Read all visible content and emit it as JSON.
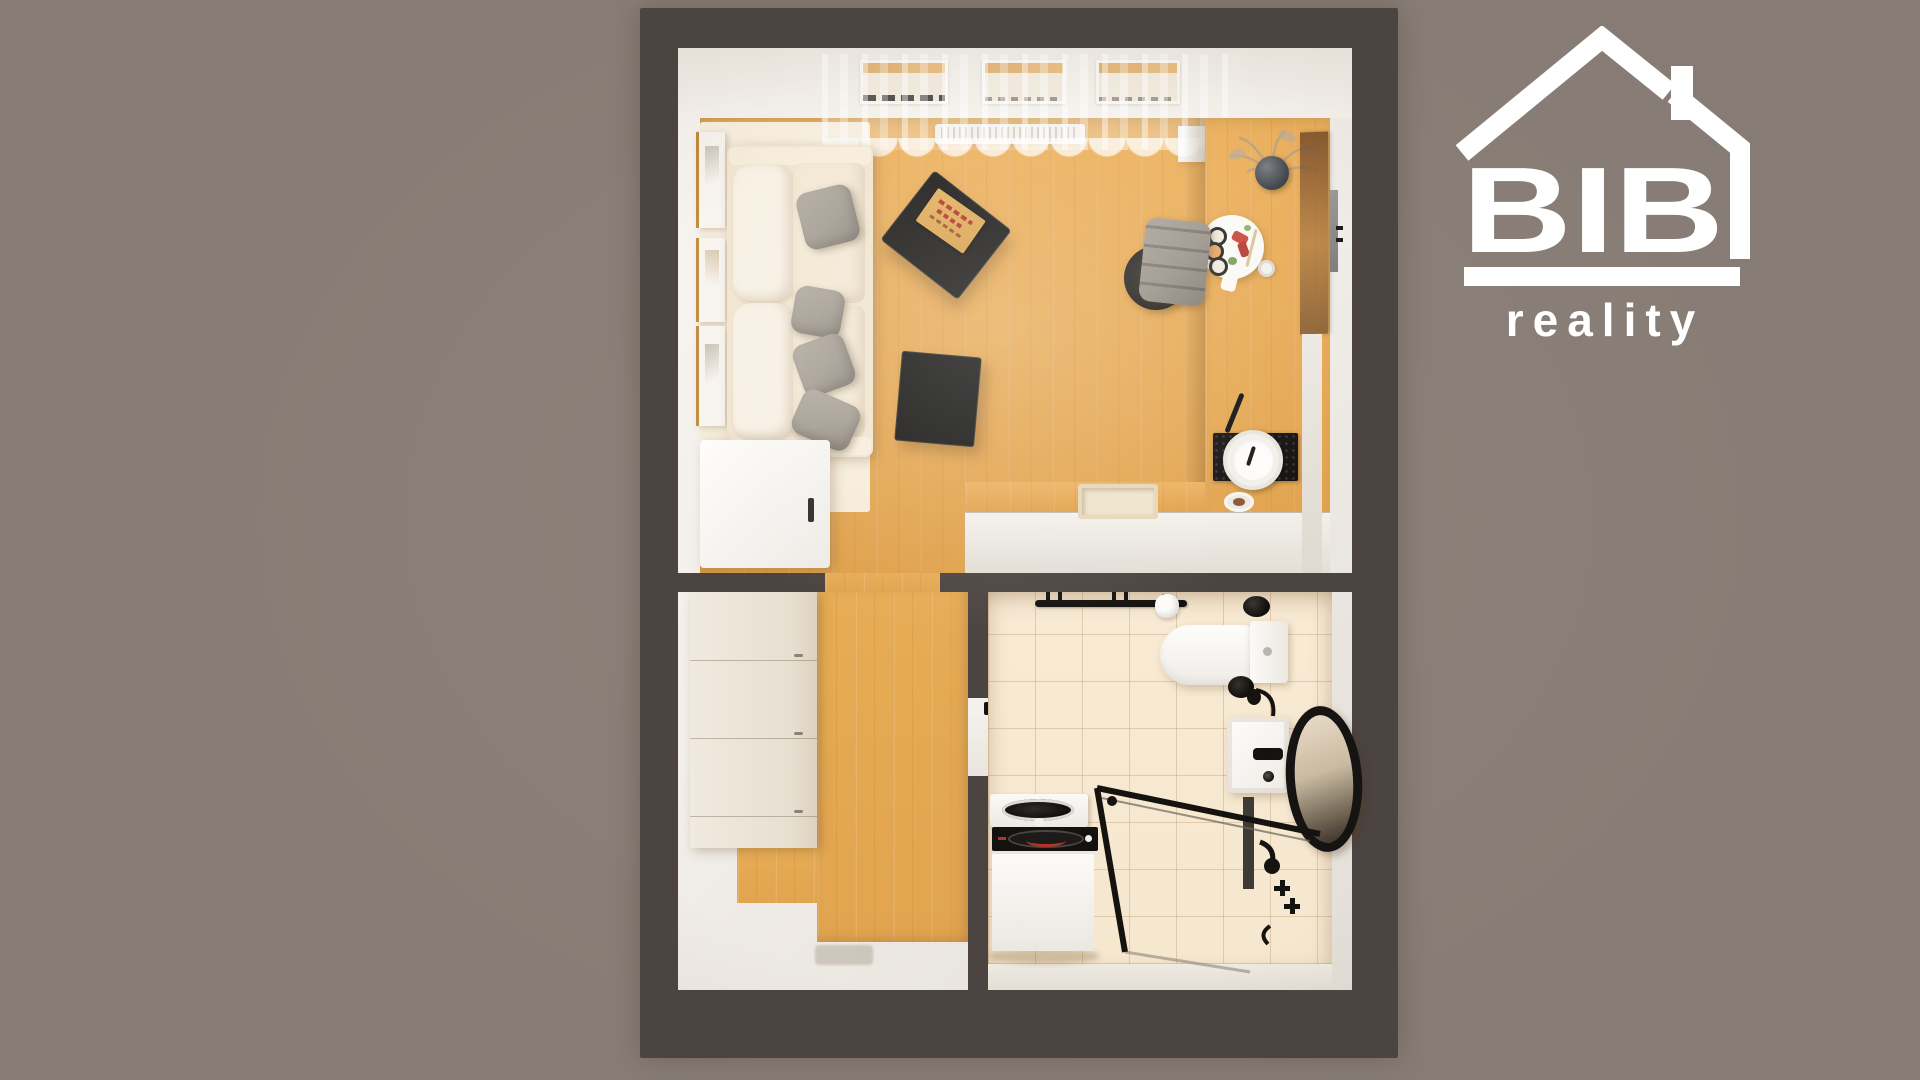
{
  "meta": {
    "title": "Studio apartment 3D top-down floor plan render",
    "width_px": 1920,
    "height_px": 1080
  },
  "logo": {
    "brand": "BIB",
    "tagline": "reality",
    "icon": "house-roof-with-chimney-icon",
    "color": "#FFFFFF"
  },
  "colors": {
    "bg": "#877C75",
    "wall": "#4B4441",
    "interior": "#F2EEE9",
    "wood-a": "#E0A14B",
    "wood-b": "#EDB25F",
    "wood-hall": "#E7AC55",
    "rug": "#F6ECD9",
    "sofa": "#F1E5D0",
    "cushion": "#F8F1E4",
    "pillow": "#A49D93",
    "tile": "#F6E7CF",
    "black": "#171512",
    "white-soft": "#FBFAF7",
    "front": "#EFEBE4",
    "pizza": "#D8A04B",
    "red": "#B43327",
    "chair": "#9A938A",
    "logo": "#FFFFFF"
  },
  "rooms": [
    {
      "name": "living-room-with-kitchen",
      "floor": "oak-wood",
      "features": [
        "three-windows",
        "sheer-curtain",
        "radiator"
      ]
    },
    {
      "name": "hallway",
      "floor": "oak-wood",
      "features": [
        "wardrobe",
        "entry-area"
      ]
    },
    {
      "name": "bathroom",
      "floor": "beige-tile",
      "features": [
        "walk-in-shower"
      ]
    }
  ],
  "furniture": {
    "living_room": [
      "cream-sofa",
      "gray-throw-pillows-x4",
      "wall-frames-x3",
      "black-coffee-table-large",
      "black-coffee-table-small",
      "pizza-box",
      "cream-rug",
      "refrigerator",
      "l-shaped-kitchen-counter",
      "induction-cooktop",
      "white-pot",
      "spatula",
      "kitchen-sink",
      "round-serving-board-with-sushi",
      "cup",
      "pampas-grass-vase",
      "gray-office-chair",
      "walnut-glass-panel",
      "wall-mounted-tv-edge",
      "plate-with-food"
    ],
    "hallway": [
      "white-wardrobe",
      "entry-mat"
    ],
    "bathroom": [
      "towel-rail",
      "toilet-paper-roll",
      "black-jar",
      "toilet",
      "toilet-brush",
      "towel-ring",
      "washbasin",
      "black-faucet",
      "oval-black-mirror",
      "shower-glass-enclosure",
      "black-shower-fixtures",
      "shower-niche",
      "washing-machine",
      "dryer"
    ]
  }
}
